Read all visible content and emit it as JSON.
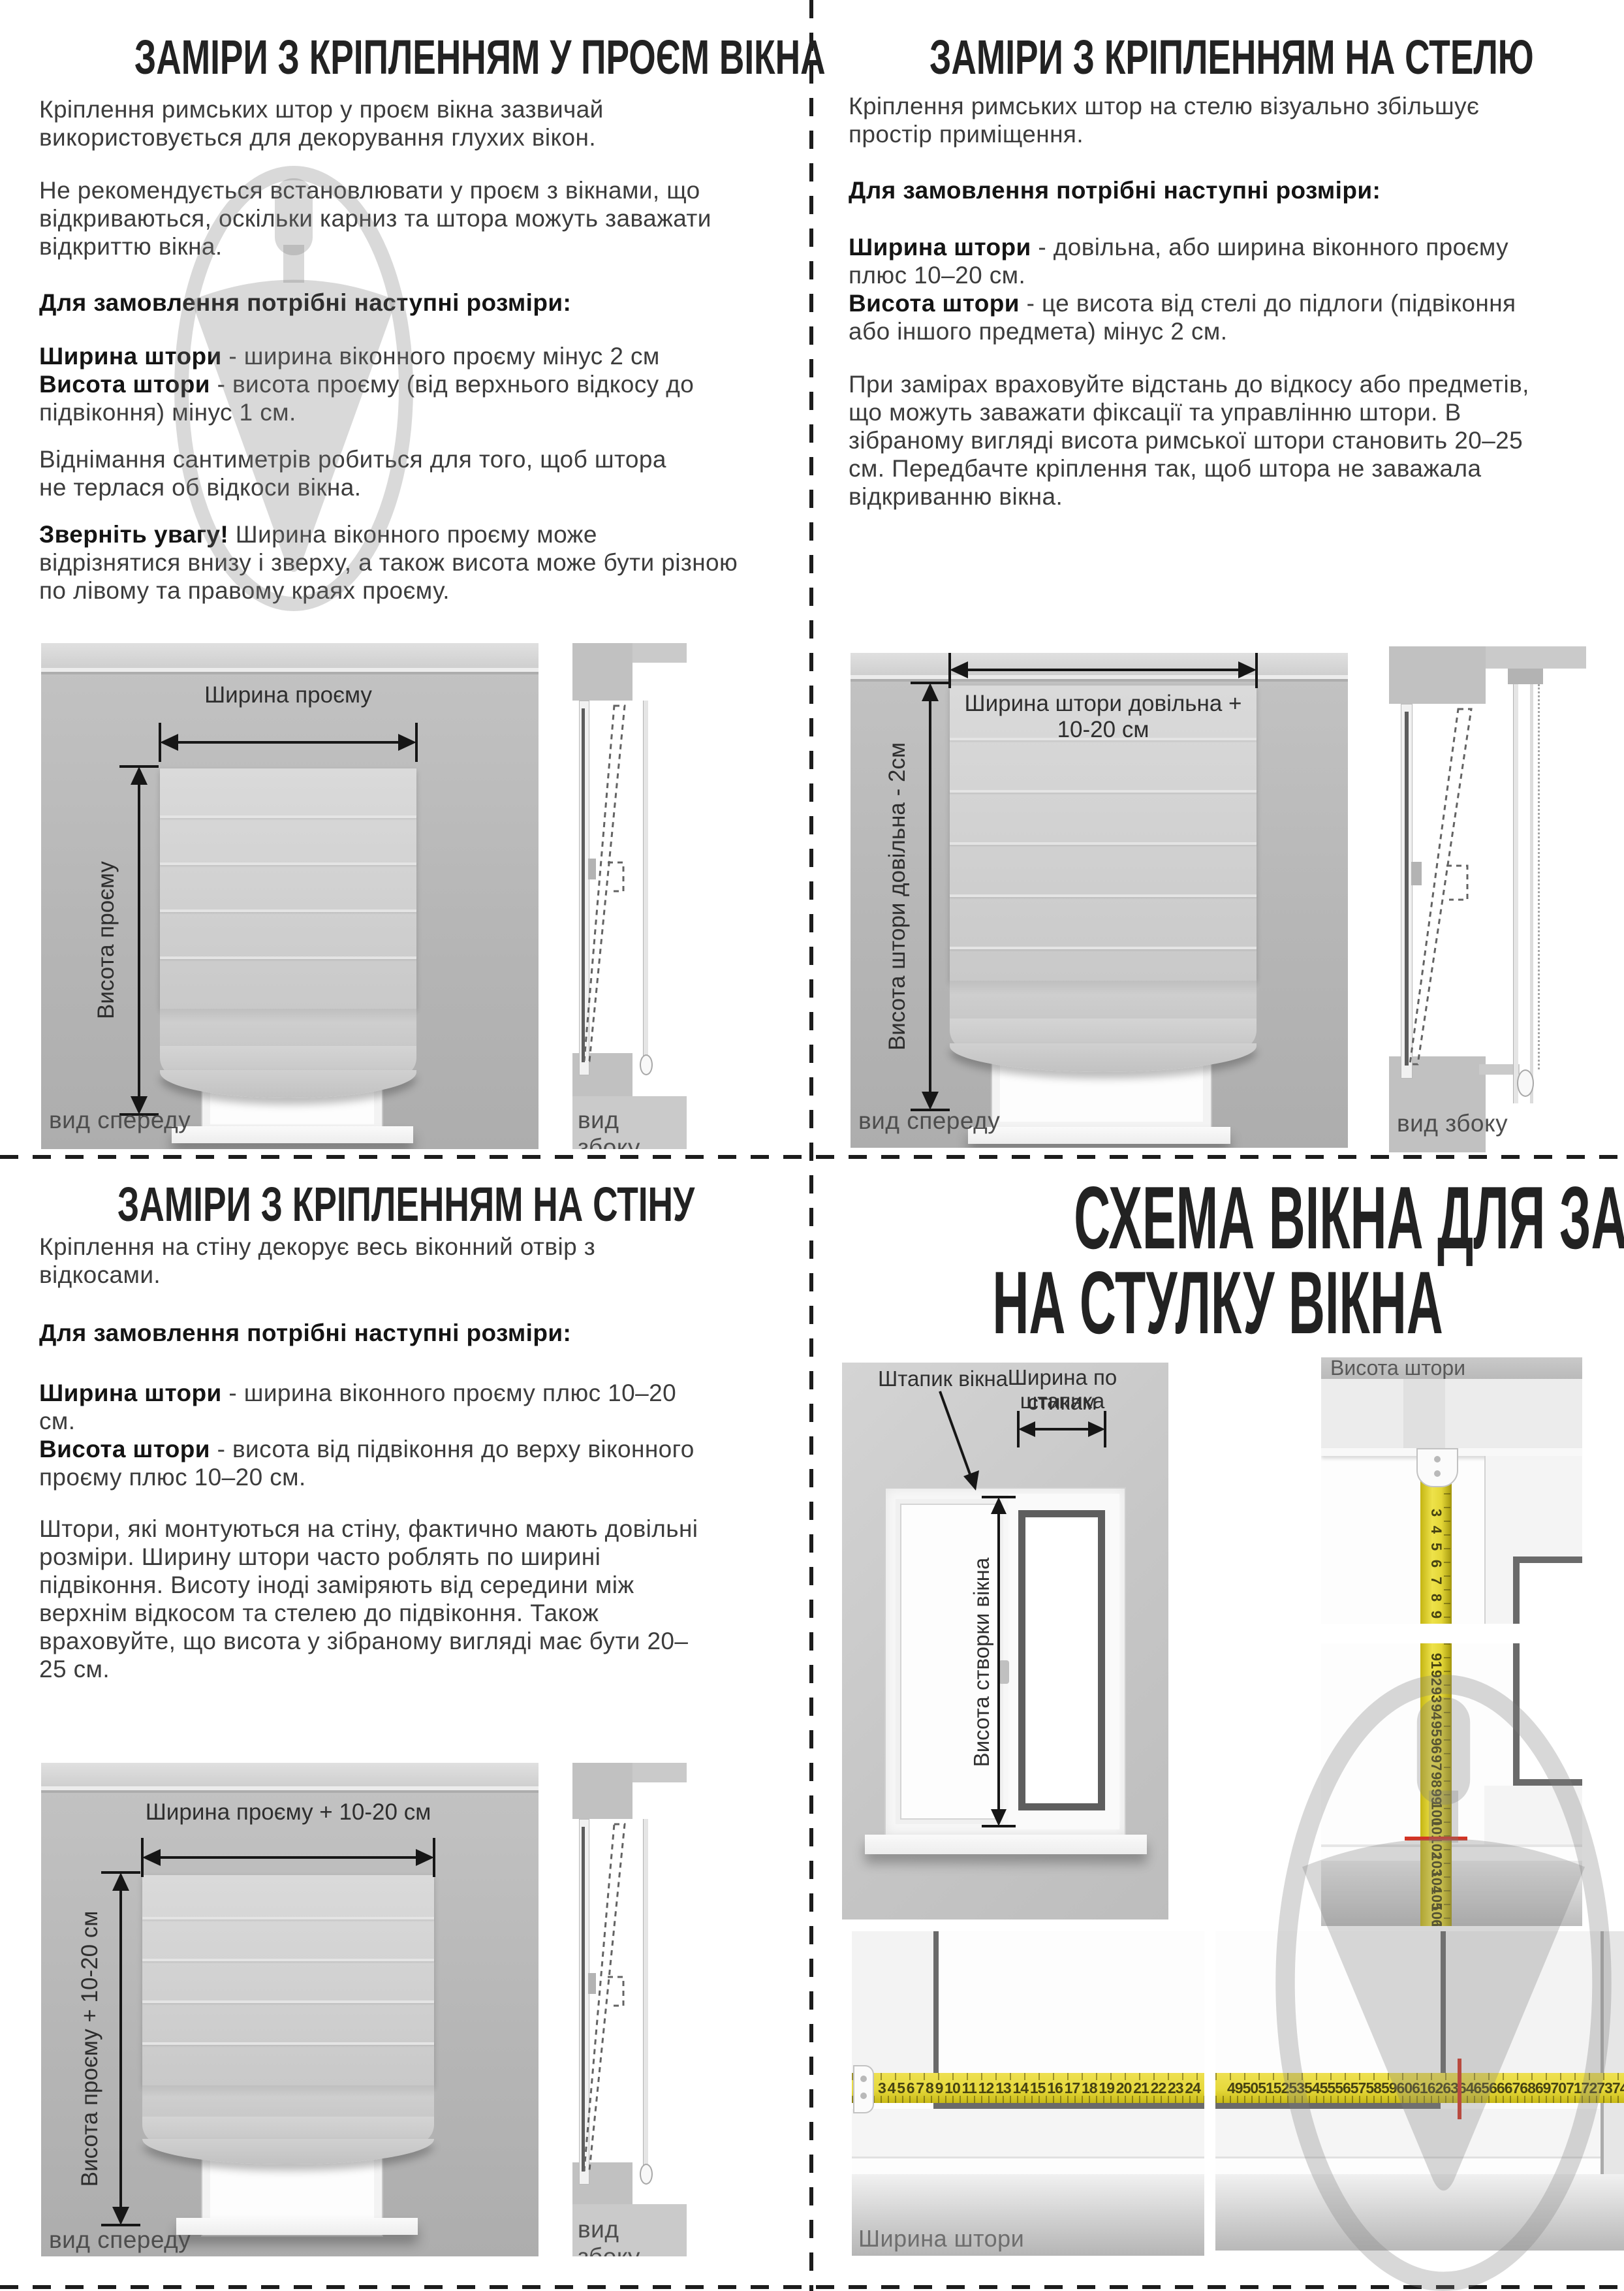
{
  "common": {
    "order_heading": "Для замовлення потрібні наступні розміри:",
    "front_caption": "вид спереду",
    "side_caption": "вид збоку",
    "width_term": "Ширина штори",
    "height_term": "Висота штори"
  },
  "opening": {
    "title": "ЗАМІРИ З КРІПЛЕННЯМ У ПРОЄМ ВІКНА",
    "p1": "Кріплення римських штор у проєм вікна зазвичай використовується для декорування глухих вікон.",
    "p2": "Не рекомендується встановлювати у проєм з вікнами, що відкриваються, оскільки карниз та штора можуть заважати відкриттю вікна.",
    "width_rest": " - ширина віконного проєму мінус 2 см",
    "height_rest": " - висота проєму (від верхнього відкосу до підвіконня) мінус 1 см.",
    "p3": "Віднімання сантиметрів робиться для того, щоб штора не терлася об відкоси вікна.",
    "note_term": "Зверніть увагу!",
    "note_rest": " Ширина віконного проєму може відрізнятися внизу і зверху, а також висота може бути різною по лівому та правому краях проєму.",
    "arrow_width_label": "Ширина проєму",
    "arrow_height_label": "Висота проєму"
  },
  "ceiling": {
    "title": "ЗАМІРИ З КРІПЛЕННЯМ НА СТЕЛЮ",
    "p1": "Кріплення римських штор на стелю візуально збільшує простір приміщення.",
    "width_rest": " - довільна, або ширина віконного проєму плюс 10–20 см.",
    "height_rest": " - це висота від стелі до підлоги (підвіконня або іншого предмета) мінус 2 см.",
    "p2": "При замірах враховуйте відстань до відкосу або предметів, що можуть заважати фіксації та управлінню штори. В зібраному вигляді висота римської штори становить 20–25 см. Передбачте кріплення так, щоб штора не заважала відкриванню вікна.",
    "arrow_width_label": "Ширина штори довільна + 10-20 см",
    "arrow_height_label": "Висота штори довільна - 2см"
  },
  "wall": {
    "title": "ЗАМІРИ З КРІПЛЕННЯМ НА СТІНУ",
    "p1": "Кріплення на стіну декорує весь віконний отвір з відкосами.",
    "width_rest": " - ширина віконного проєму плюс 10–20 см.",
    "height_rest": " - висота від підвіконня до верху віконного проєму плюс 10–20 см.",
    "p2": "Штори, які монтуються на стіну, фактично мають довільні розміри. Ширину штори часто роблять по ширині підвіконня. Висоту іноді заміряють від середини між верхнім відкосом та стелею до підвіконня. Також враховуйте, що висота у зібраному вигляді має бути 20–25 см.",
    "arrow_width_label": "Ширина проєму + 10-20 см",
    "arrow_height_label": "Висота проєму + 10-20 см"
  },
  "sash": {
    "title_line1": "СХЕМА ВІКНА ДЛЯ ЗАМІРІВ",
    "title_line2": "НА СТУЛКУ ВІКНА",
    "bead_label": "Штапик вікна",
    "bead_width_label_1": "Ширина по стикам",
    "bead_width_label_2": "штапика",
    "sash_height_label": "Висота створки вікна",
    "height_photo_label": "Висота штори",
    "width_photo_label": "Ширина штори",
    "tape_vertical_top": [
      3,
      4,
      5,
      6,
      7,
      8,
      9,
      10,
      11
    ],
    "tape_vertical_bottom": [
      91,
      92,
      93,
      94,
      95,
      96,
      97,
      98,
      99,
      100,
      101,
      102,
      103,
      104,
      105,
      106,
      107,
      108,
      109
    ],
    "tape_horizontal_left": [
      3,
      4,
      5,
      6,
      7,
      8,
      9,
      10,
      11,
      12,
      13,
      14,
      15,
      16,
      17,
      18,
      19,
      20,
      21,
      22,
      23,
      24
    ],
    "tape_horizontal_right": [
      49,
      50,
      51,
      52,
      53,
      54,
      55,
      56,
      57,
      58,
      59,
      60,
      61,
      62,
      63,
      64,
      65,
      66,
      67,
      68,
      69,
      70,
      71,
      72,
      73,
      74,
      75,
      76,
      77,
      78,
      79
    ],
    "red_mark_height_cm": 104,
    "red_mark_width_cm": 73
  }
}
